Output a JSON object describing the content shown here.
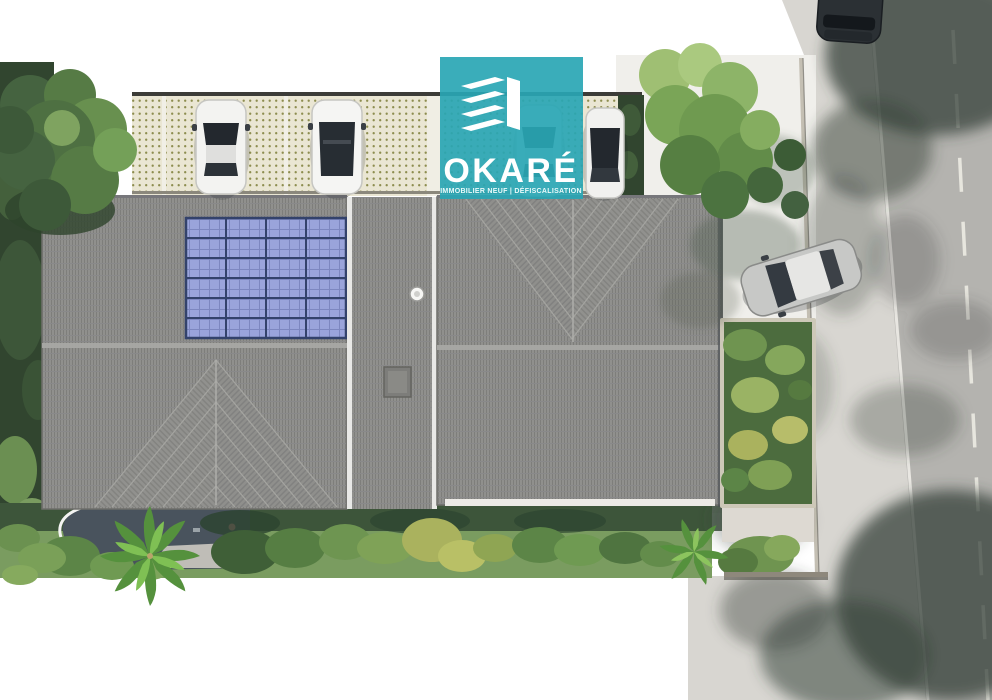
{
  "logo": {
    "title": "OKARÉ",
    "tagline": "IMMOBILIER NEUF | DÉFISCALISATION",
    "icon": "stacked-building-icon",
    "brand_color": "#29a6b4"
  },
  "palette": {
    "roof": "#90908d",
    "solar_panel": "#9aa4db",
    "solar_grid": "#33426b",
    "lawn": "#7a9c60",
    "hedge": "#31452f",
    "pavers": "#eae6d3",
    "paver_dot": "#8d8d4f",
    "courtyard": "#f0efeb",
    "sidewalk": "#d8d6d1",
    "road": "#b4b3af",
    "patio": "#49535d",
    "car_white": "#f3f3f1",
    "car_silver": "#c7c8c6",
    "car_dark": "#2b3034",
    "shadow": "#36413a"
  }
}
